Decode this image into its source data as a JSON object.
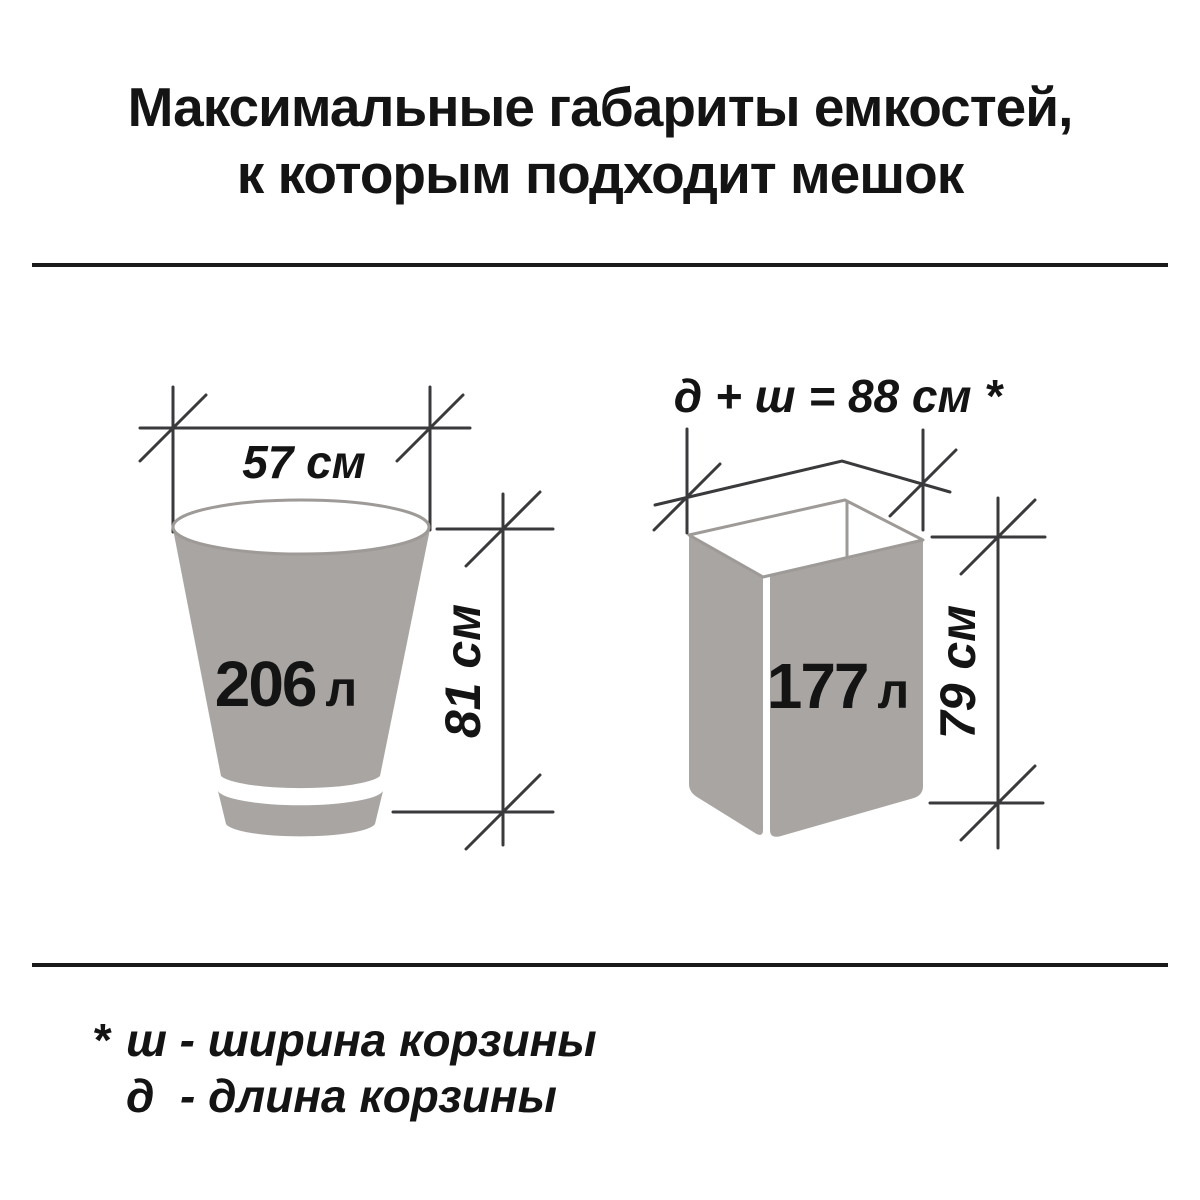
{
  "title": {
    "line1": "Максимальные габариты емкостей,",
    "line2": "к которым подходит мешок"
  },
  "bucket": {
    "width_label": "57 см",
    "volume_value": "206",
    "volume_unit": "л",
    "height_label": "81 см"
  },
  "basket": {
    "dimension_formula": "д + ш = 88 см *",
    "volume_value": "177",
    "volume_unit": "л",
    "height_label": "79 см"
  },
  "footnote": {
    "marker": "*",
    "line1": "ш - ширина корзины",
    "line2": "д  - длина корзины"
  },
  "colors": {
    "container_fill": "#a9a5a3",
    "rim_stroke": "#9e9a98",
    "line": "#3a3a3c",
    "divider": "#1a1a1a",
    "text": "#141414"
  }
}
